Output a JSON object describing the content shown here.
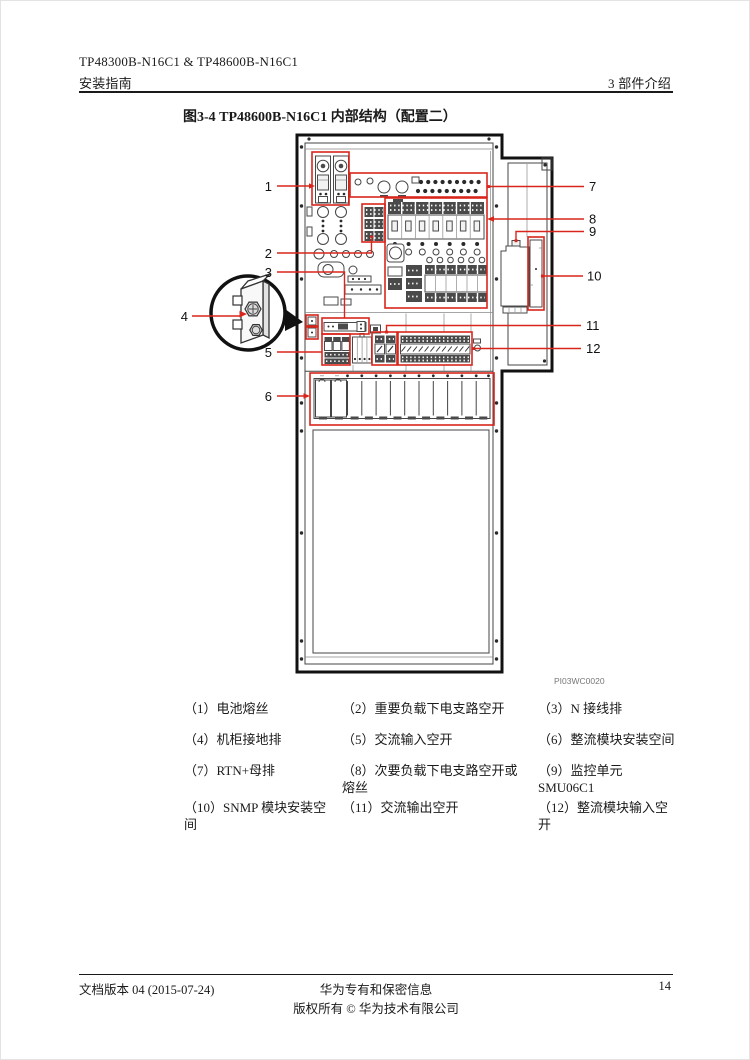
{
  "header": {
    "line1": "TP48300B-N16C1 & TP48600B-N16C1",
    "line2": "安装指南",
    "chapter": "3 部件介绍"
  },
  "figure": {
    "title": "图3-4  TP48600B-N16C1 内部结构（配置二）",
    "image_code": "PI03WC0020"
  },
  "callouts": {
    "c1": "1",
    "c2": "2",
    "c3": "3",
    "c4": "4",
    "c5": "5",
    "c6": "6",
    "c7": "7",
    "c8": "8",
    "c9": "9",
    "c10": "10",
    "c11": "11",
    "c12": "12"
  },
  "legend": {
    "rows": [
      [
        "（1）电池熔丝",
        "（2）重要负载下电支路空开",
        "（3）N 接线排"
      ],
      [
        "（4）机柜接地排",
        "（5）交流输入空开",
        "（6）整流模块安装空间"
      ],
      [
        "（7）RTN+母排",
        "（8）次要负载下电支路空开或\n熔丝",
        "（9）监控单元\nSMU06C1"
      ],
      [
        "（10）SNMP 模块安装空\n间",
        "（11）交流输出空开",
        "（12）整流模块输入空\n开"
      ]
    ]
  },
  "footer": {
    "version": "文档版本 04 (2015-07-24)",
    "confidential": "华为专有和保密信息",
    "copyright": "版权所有 © 华为技术有限公司",
    "page": "14"
  },
  "colors": {
    "callout_red": "#d9261c"
  }
}
